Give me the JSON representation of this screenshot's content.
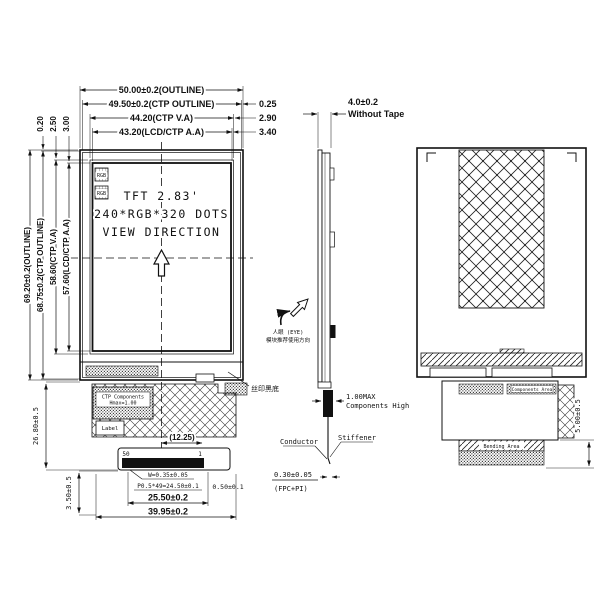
{
  "front_view": {
    "display_label_line1": "TFT 2.83'",
    "display_label_line2": "240*RGB*320 DOTS",
    "display_label_line3": "VIEW DIRECTION",
    "rgb_label_1": "RGB",
    "rgb_label_2": "RGB",
    "dim_width_outline": "50.00±0.2(OUTLINE)",
    "dim_width_ctp_outline": "49.50±0.2(CTP OUTLINE)",
    "dim_width_ctp_va": "44.20(CTP V.A)",
    "dim_width_lcd_aa": "43.20(LCD/CTP A.A)",
    "offset_right_1": "0.25",
    "offset_right_2": "2.90",
    "offset_right_3": "3.40",
    "dim_height_outline": "69.20±0.2(OUTLINE)",
    "dim_height_ctp_outline": "68.75±0.2(CTP OUTLINE)",
    "dim_height_ctp_va": "58.60(CTP V.A)",
    "dim_height_lcd_aa": "57.60(LCD/CTP A.A)",
    "offset_top_1": "0.20",
    "offset_top_2": "2.50",
    "offset_top_3": "3.00",
    "silk_print_note": "丝印黑底",
    "ctp_components_note_line1": "CTP Components",
    "ctp_components_note_line2": "Hmax=1.00",
    "label_box_text": "Label",
    "dim_fpc_offset": "(12.25)",
    "pin_number_left": "50",
    "pin_number_right": "1",
    "dim_pin_width": "W=0.35±0.05",
    "dim_pin_pitch": "P0.5*49=24.50±0.1",
    "dim_pin_end": "0.50±0.1",
    "dim_connector_width": "25.50±0.2",
    "dim_fpc_width": "39.95±0.2",
    "dim_connector_height": "3.50±0.5",
    "dim_fpc_length": "26.80±0.5"
  },
  "side_view": {
    "dim_thickness": "4.0±0.2",
    "dim_thickness_note": "Without Tape",
    "usage_note_line1": "人眼 (EYE)",
    "usage_note_line2": "模块推荐使用方向",
    "components_height_line1": "1.00MAX",
    "components_height_line2": "Components High",
    "conductor_label": "Conductor",
    "stiffener_label": "Stiffener",
    "dim_fpc_thickness": "0.30±0.05",
    "fpc_material_note": "(FPC+PI)"
  },
  "back_view": {
    "components_area_label": "Components Area",
    "bending_area_label": "Bending Area",
    "dim_bending": "5.00±0.5"
  }
}
